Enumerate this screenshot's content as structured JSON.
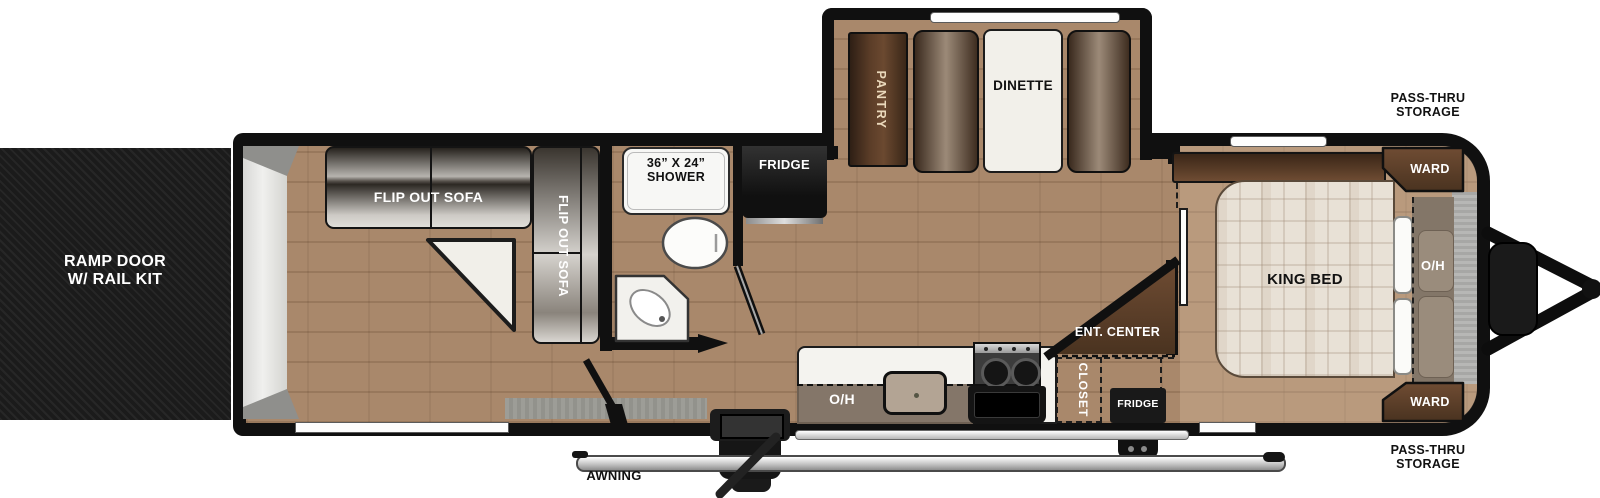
{
  "floorplan": {
    "type": "travel-trailer-floorplan",
    "labels": {
      "ramp_line1": "RAMP DOOR",
      "ramp_line2": "W/ RAIL KIT",
      "flip_sofa_h": "FLIP OUT SOFA",
      "flip_sofa_v": "FLIP OUT SOFA",
      "shower_line1": "36” X 24”",
      "shower_line2": "SHOWER",
      "fridge_main": "FRIDGE",
      "pantry": "PANTRY",
      "dinette": "DINETTE",
      "oh_kitchen": "O/H",
      "closet": "CLOSET",
      "ent_center": "ENT. CENTER",
      "fridge_bedroom": "FRIDGE",
      "king_bed": "KING BED",
      "ward_top": "WARD",
      "ward_bottom": "WARD",
      "oh_bedroom": "O/H",
      "pass_thru_top_line1": "PASS-THRU",
      "pass_thru_top_line2": "STORAGE",
      "pass_thru_bottom_line1": "PASS-THRU",
      "pass_thru_bottom_line2": "STORAGE",
      "awning": "AWNING"
    },
    "colors": {
      "wall": "#101010",
      "floor": "#a9886b",
      "ramp_door": "#1b1b1b",
      "cabinet_brown": "#5a4027",
      "appliance_black": "#191919",
      "counter_white": "#f4f3ef",
      "overhead_gray": "#78685a",
      "bed_fabric": "#e8e1d6",
      "sofa_metallic": "#d6d3cf",
      "pantry_text": "#ead9bc"
    }
  }
}
